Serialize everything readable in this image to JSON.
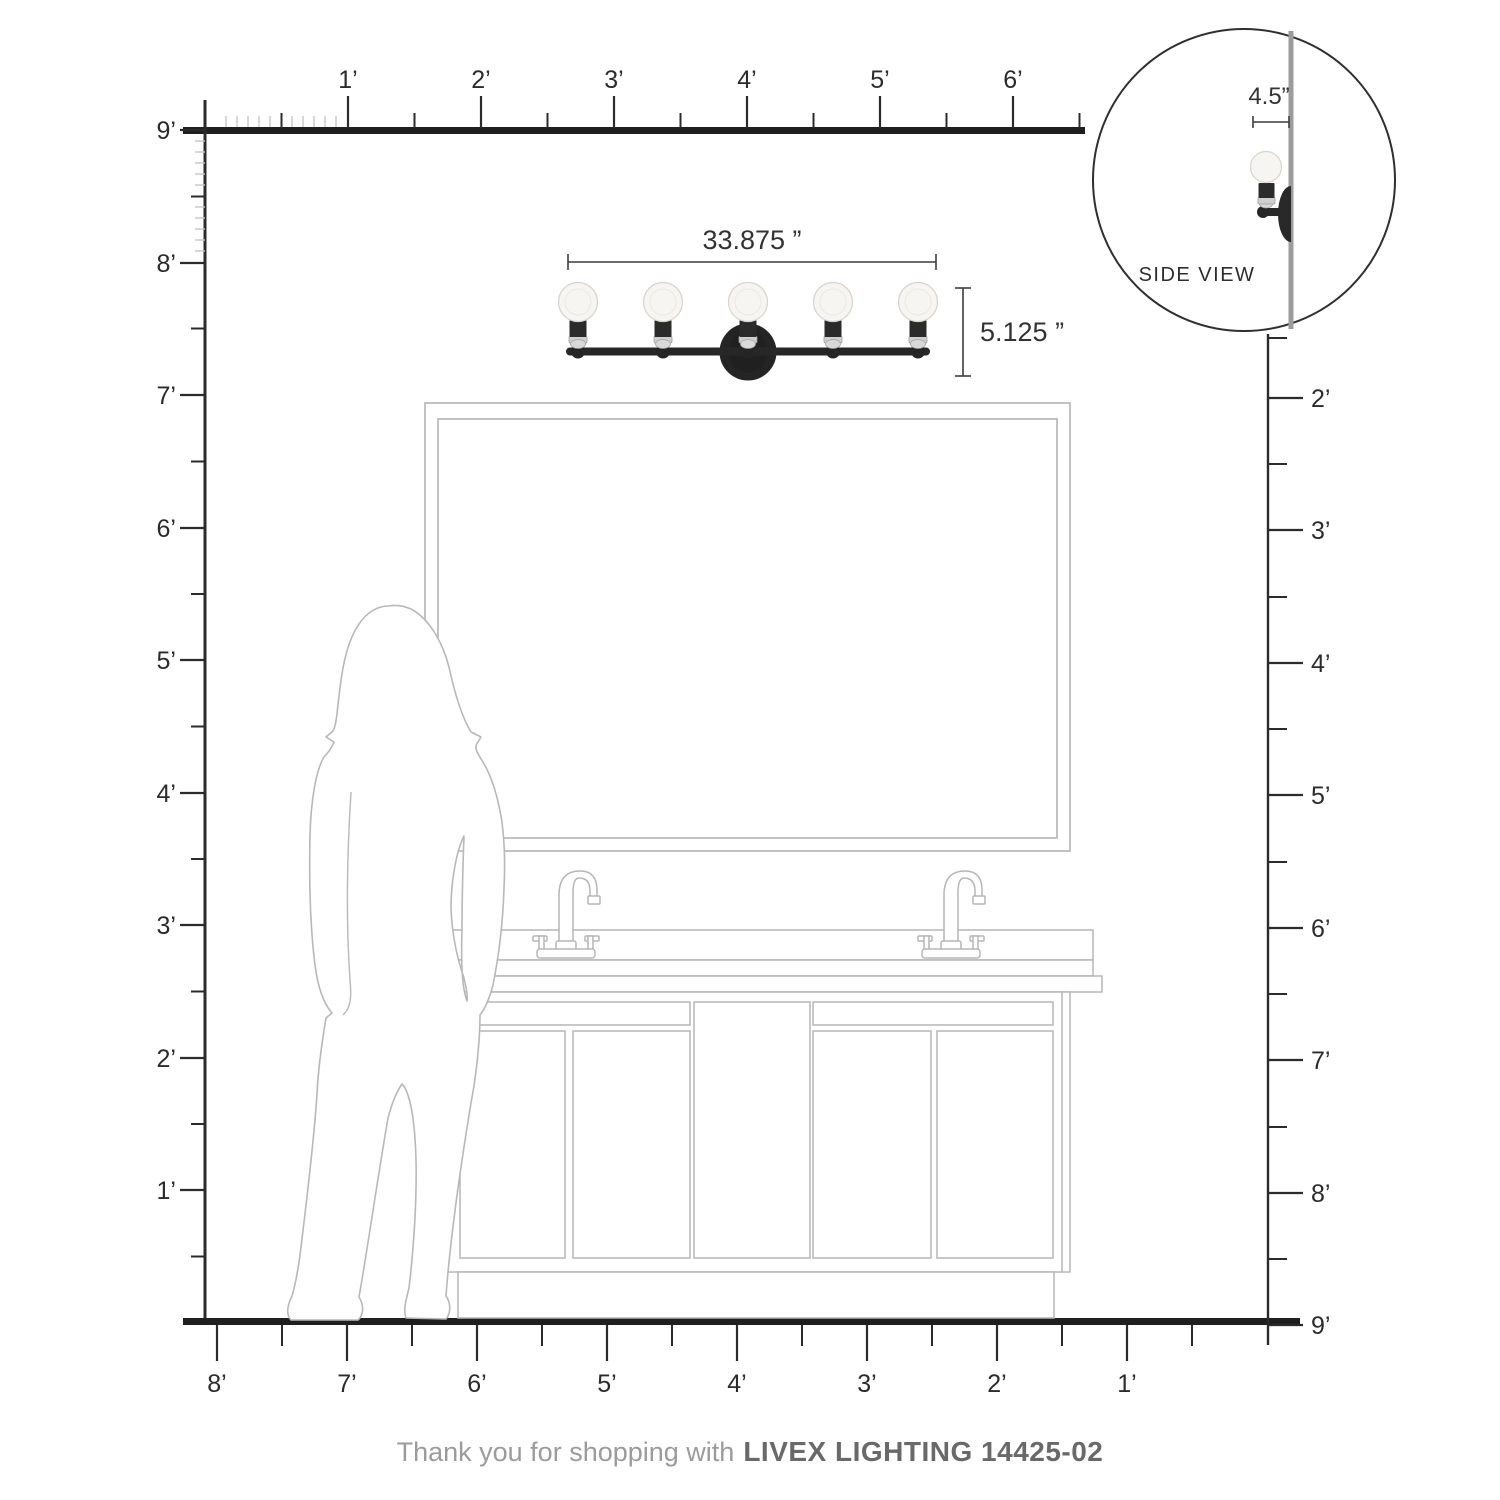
{
  "footer": {
    "prefix": "Thank you for shopping with",
    "brand_model": "LIVEX LIGHTING 14425-02"
  },
  "fixture": {
    "bulb_count": 5,
    "width_label": "33.875 ”",
    "height_label": "5.125 ”"
  },
  "side_view": {
    "label": "SIDE VIEW",
    "depth_label": "4.5”"
  },
  "rulers": {
    "unit": "feet",
    "top": {
      "labels": [
        "1’",
        "2’",
        "3’",
        "4’",
        "5’",
        "6’"
      ]
    },
    "left": {
      "labels": [
        "9’",
        "8’",
        "7’",
        "6’",
        "5’",
        "4’",
        "3’",
        "2’",
        "1’"
      ]
    },
    "right": {
      "labels": [
        "2’",
        "3’",
        "4’",
        "5’",
        "6’",
        "7’",
        "8’",
        "9’"
      ]
    },
    "bottom": {
      "labels": [
        "8’",
        "7’",
        "6’",
        "5’",
        "4’",
        "3’",
        "2’",
        "1’"
      ]
    }
  },
  "colors": {
    "line_dark": "#2b2b2b",
    "thick_bar": "#1f1f1f",
    "tick_light": "#c8c8c8",
    "line_art_gray": "#b5b5b5",
    "wall_gray": "#9c9c9c",
    "fixture_black": "#262626",
    "chrome": "#cfcfcf",
    "bulb_glass": "#f6f5f1",
    "dimension": "#333333",
    "footer_light": "#9b9b9b",
    "footer_dark": "#696969"
  }
}
